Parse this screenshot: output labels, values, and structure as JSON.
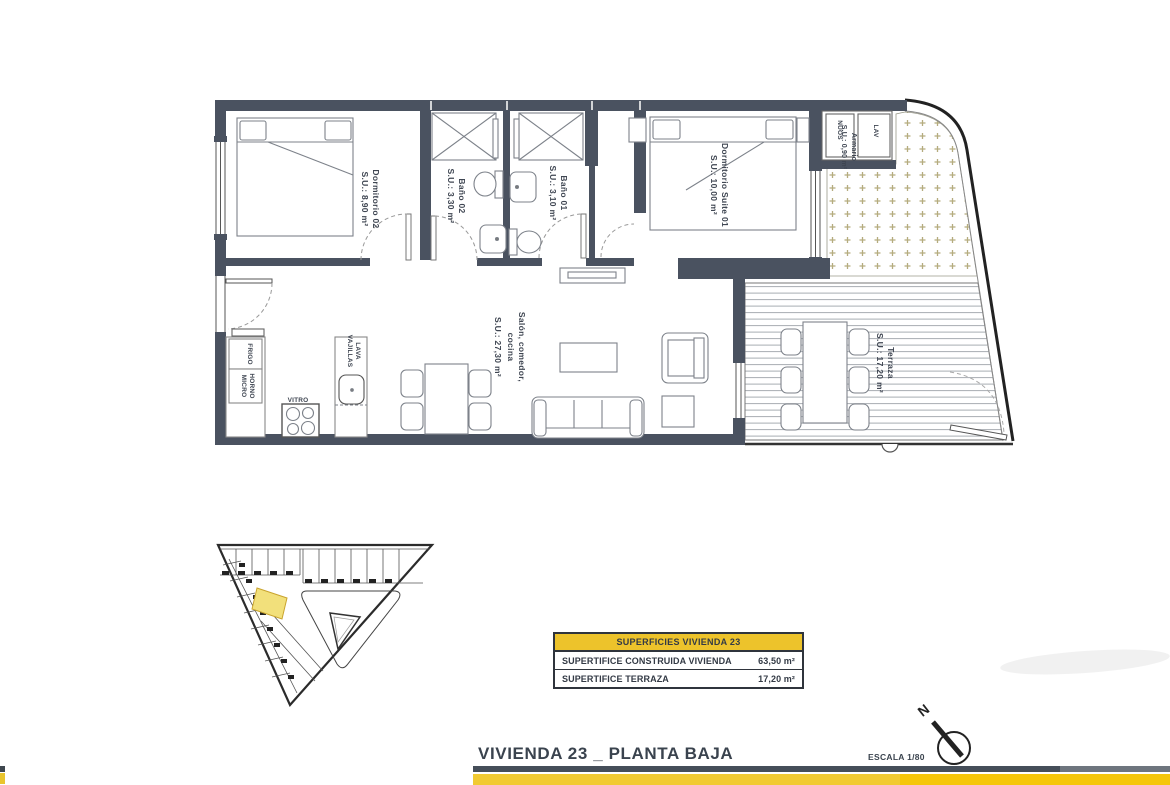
{
  "plan": {
    "rooms": {
      "dormitorio02": {
        "name": "Dormitorio 02",
        "area": "S.U.: 8,90 m²"
      },
      "bano02": {
        "name": "Baño 02",
        "area": "S.U.: 3,30 m²"
      },
      "bano01": {
        "name": "Baño 01",
        "area": "S.U.: 3,10 m²"
      },
      "suite01": {
        "name": "Dormitorio Suite 01",
        "area": "S.U.: 10,00 m²"
      },
      "armario": {
        "name": "Armario",
        "area": "S.U.: 0,90 m²"
      },
      "salon": {
        "name_line1": "Salón, comedor,",
        "name_line2": "cocina",
        "area": "S.U.: 27,30 m²"
      },
      "terraza": {
        "name": "Terraza",
        "area": "S.U.: 17,20 m²"
      }
    },
    "labels": {
      "frigo": "FRIGO",
      "horno": "HORNO",
      "micro": "MICRO",
      "vitro": "VITRO",
      "lava": "LAVA",
      "vajillas": "VAJILLAS",
      "lav": "LAV",
      "nuos": "NUOS"
    }
  },
  "summary_table": {
    "header": "SUPERFICIES VIVIENDA 23",
    "rows": [
      {
        "label": "SUPERTIFICE CONSTRUIDA VIVIENDA",
        "value": "63,50 m²"
      },
      {
        "label": "SUPERTIFICE TERRAZA",
        "value": "17,20 m²"
      }
    ]
  },
  "footer": {
    "title": "VIVIENDA 23 _ PLANTA BAJA",
    "scale_label": "ESCALA 1/80",
    "north_label": "N"
  },
  "colors": {
    "wall": "#4a5260",
    "accent_yellow": "#edc32b",
    "line_dark": "#2f343c",
    "gravel": "#b5ac7e"
  }
}
